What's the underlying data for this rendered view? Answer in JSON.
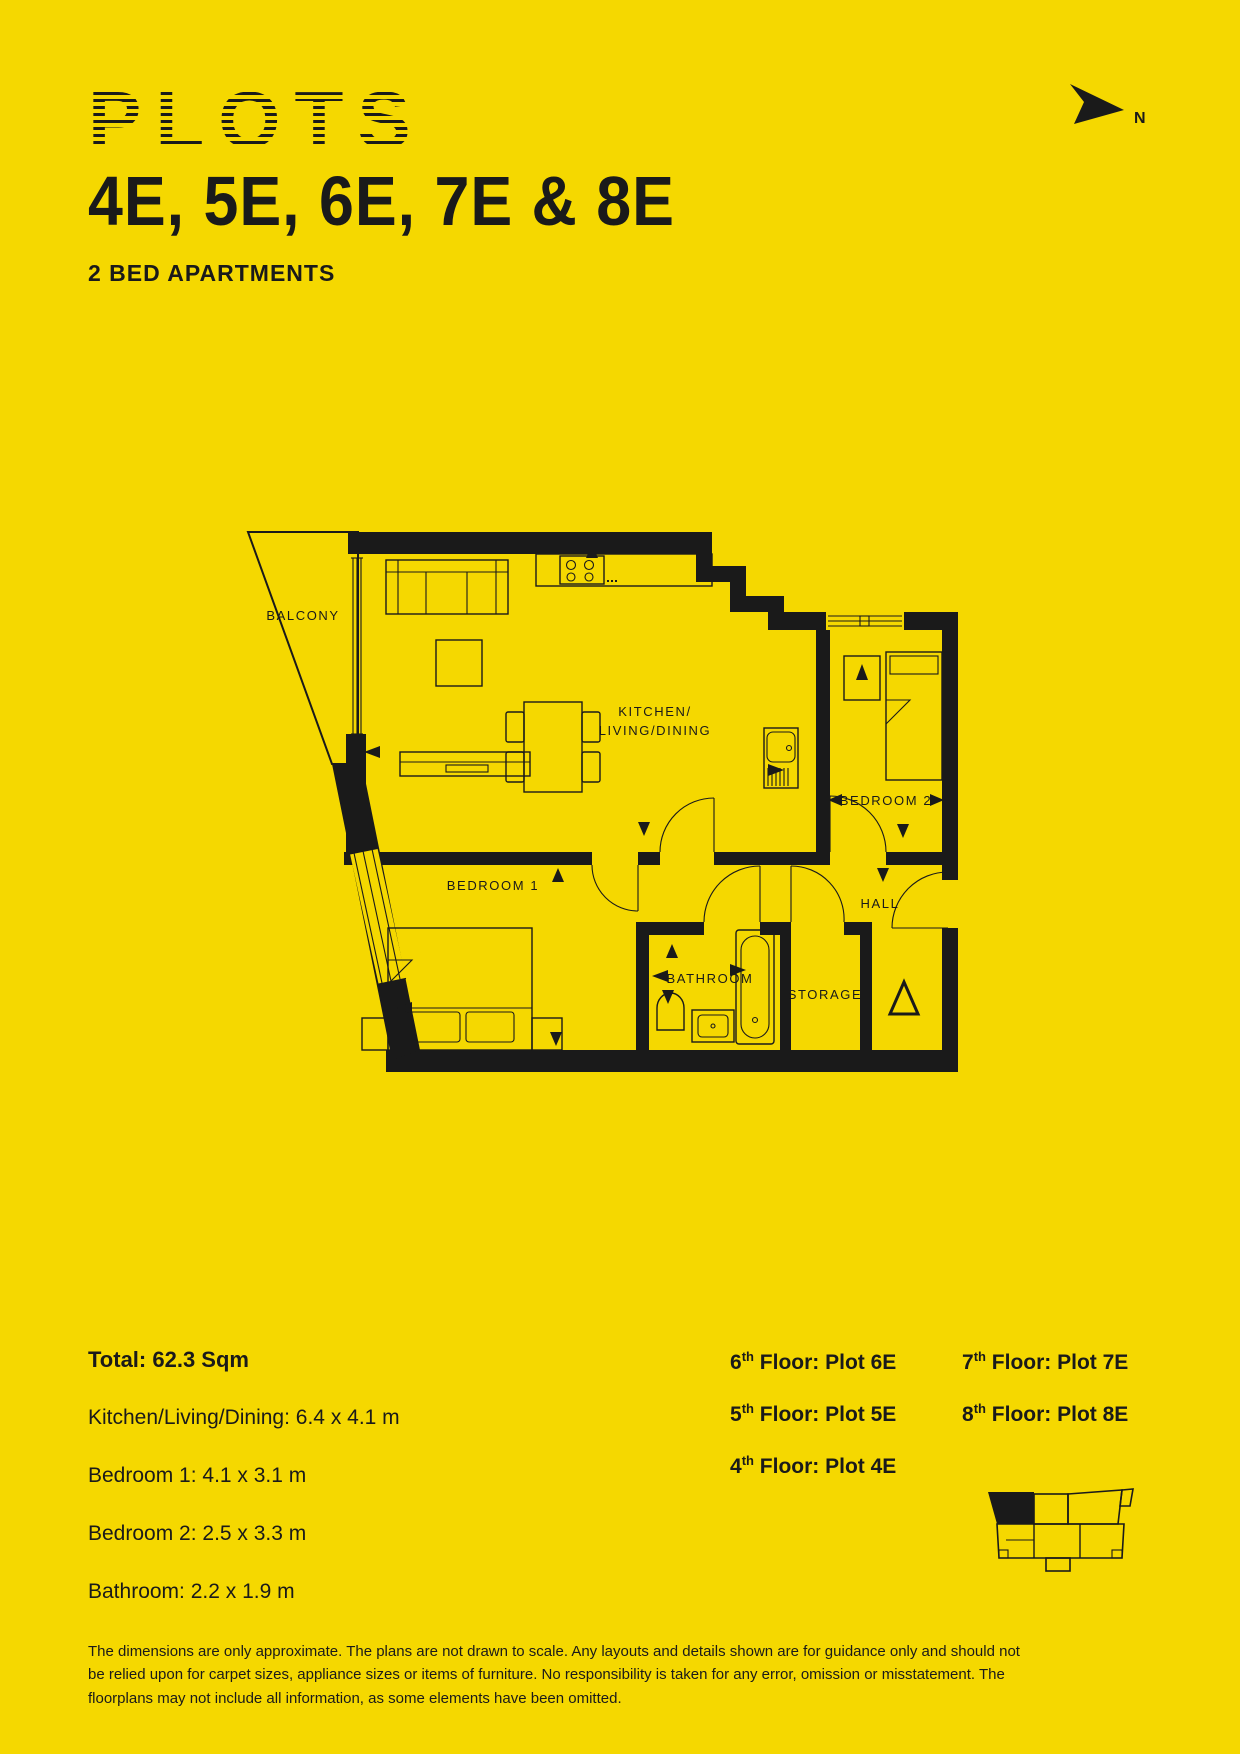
{
  "colors": {
    "background": "#F5D800",
    "ink": "#1A1A1A"
  },
  "header": {
    "title": "PLOTS",
    "plots": "4E, 5E, 6E, 7E & 8E",
    "subtitle": "2 BED APARTMENTS",
    "compass": "N"
  },
  "plan": {
    "labels": {
      "balcony": "BALCONY",
      "kitchen_line1": "KITCHEN/",
      "kitchen_line2": "LIVING/DINING",
      "bedroom1": "BEDROOM 1",
      "bedroom2": "BEDROOM 2",
      "hall": "HALL",
      "bathroom": "BATHROOM",
      "storage": "STORAGE"
    }
  },
  "stats": {
    "total": "Total: 62.3 Sqm",
    "lines": [
      "Kitchen/Living/Dining: 6.4 x 4.1 m",
      "Bedroom 1: 4.1 x 3.1 m",
      "Bedroom 2: 2.5 x 3.3 m",
      "Bathroom: 2.2 x 1.9 m"
    ]
  },
  "floors": {
    "column1": [
      {
        "num": "6",
        "sup": "th",
        "rest": " Floor: Plot 6E"
      },
      {
        "num": "5",
        "sup": "th",
        "rest": " Floor: Plot 5E"
      },
      {
        "num": "4",
        "sup": "th",
        "rest": " Floor: Plot 4E"
      }
    ],
    "column2": [
      {
        "num": "7",
        "sup": "th",
        "rest": " Floor: Plot 7E"
      },
      {
        "num": "8",
        "sup": "th",
        "rest": " Floor: Plot 8E"
      }
    ]
  },
  "disclaimer": "The dimensions are only approximate. The plans are not drawn to scale. Any layouts and details shown are for guidance only and should not be relied upon for carpet sizes, appliance sizes or items of furniture. No responsibility is taken for any error, omission or misstatement. The floorplans may not include all information, as some elements have been omitted."
}
